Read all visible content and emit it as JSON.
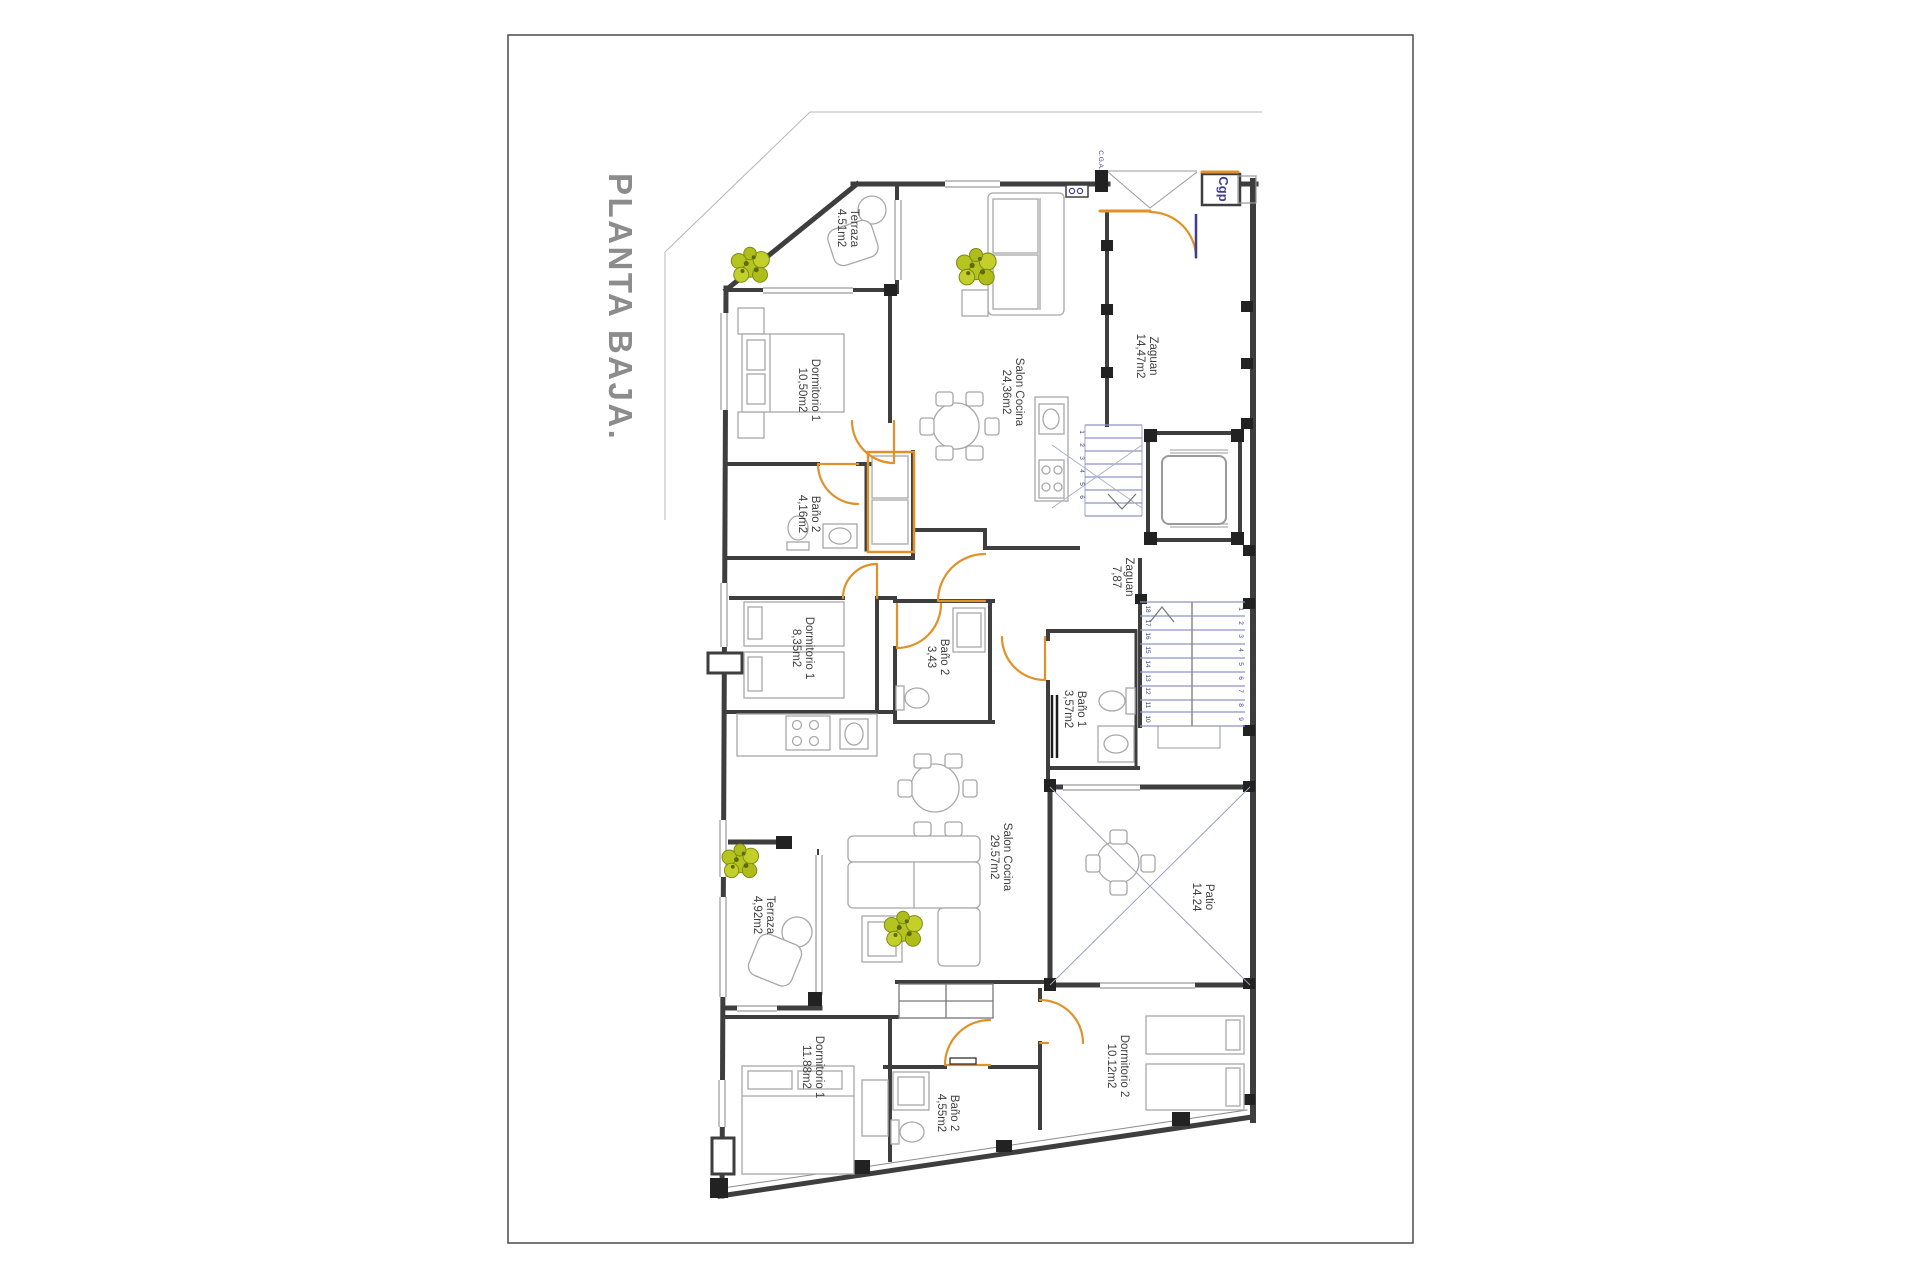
{
  "title": "PLANTA BAJA.",
  "colors": {
    "door_accent": "#e0912a",
    "stair_blue": "#8d93c8",
    "annotation_navy": "#3c3f8f",
    "label_gray": "#3f3f3f",
    "title_gray": "#8c8c8c",
    "wall": "#3e3e3e",
    "plant_green": "#b5c41f"
  },
  "annotations": {
    "cga": "C.G.A.",
    "cgp": "Cgp"
  },
  "rooms": {
    "terraza_top": {
      "name": "Terraza",
      "area": "4.51m2"
    },
    "dormitorio1_top": {
      "name": "Dormitorio 1",
      "area": "10,50m2"
    },
    "salon_cocina_top": {
      "name": "Salon Cocina",
      "area": "24,36m2"
    },
    "zaguan_entry": {
      "name": "Zaguan",
      "area": "14,47m2"
    },
    "bano2_top": {
      "name": "Baño 2",
      "area": "4,16m2"
    },
    "dormitorio1b_top": {
      "name": "Dormitorio 1",
      "area": "8,35m2"
    },
    "bano2_mid": {
      "name": "Baño 2",
      "area": "3,43"
    },
    "zaguan_mid": {
      "name": "Zaguan",
      "area": "7,87"
    },
    "bano1_bottom": {
      "name": "Baño 1",
      "area": "3,57m2"
    },
    "patio": {
      "name": "Patio",
      "area": "14.24"
    },
    "salon_cocina_bottom": {
      "name": "Salon Cocina",
      "area": "29.57m2"
    },
    "terraza_bottom": {
      "name": "Terraza",
      "area": "4,92m2"
    },
    "dormitorio1_bottom": {
      "name": "Dormitorio 1",
      "area": "11.88m2"
    },
    "bano2_bottom": {
      "name": "Baño 2",
      "area": "4,55m2"
    },
    "dormitorio2_bottom": {
      "name": "Dormitorio 2",
      "area": "10.12m2"
    }
  },
  "stairs": {
    "upper_flight": [
      "1",
      "2",
      "3",
      "4",
      "5",
      "6"
    ],
    "lower_left_flight": [
      "18",
      "17",
      "16",
      "15",
      "14",
      "13",
      "12",
      "11",
      "10"
    ],
    "lower_right_flight": [
      "1",
      "2",
      "3",
      "4",
      "5",
      "6",
      "7",
      "8",
      "9"
    ]
  }
}
